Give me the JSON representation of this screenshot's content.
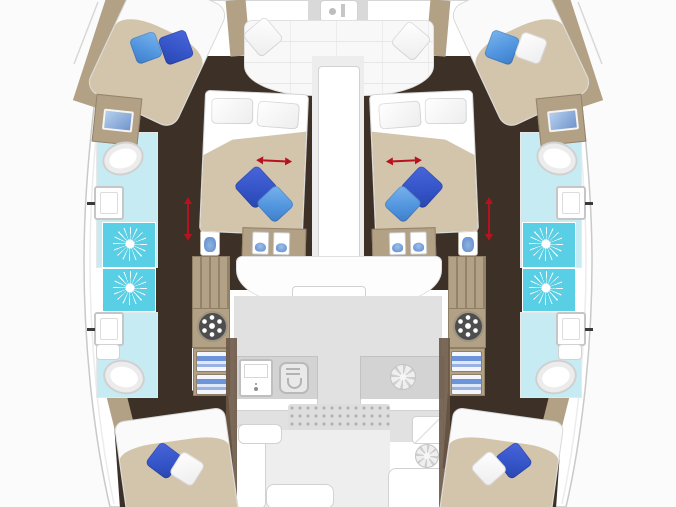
{
  "diagram": {
    "type": "catamaran-yacht-deck-floor-plan",
    "orientation": "bow-at-top, symmetric port/starboard hulls",
    "cabins": [
      {
        "name": "forward-cabin-port",
        "items": [
          "diagonal-double-bed",
          "navy-pillow",
          "blue-pillow",
          "vanity-with-sink",
          "toilet",
          "washbasin",
          "two-showers"
        ]
      },
      {
        "name": "forward-cabin-starboard",
        "items": [
          "diagonal-double-bed",
          "blue-pillow",
          "white-pillow",
          "vanity-with-sink",
          "toilet",
          "washbasin",
          "two-showers"
        ]
      },
      {
        "name": "guest-cabin-port-center",
        "items": [
          "island-double-bed",
          "two-white-pillows",
          "navy-pillow",
          "blue-pillow",
          "red-slide-arrow",
          "foot-shelf-with-two-basins"
        ]
      },
      {
        "name": "guest-cabin-starboard-center",
        "items": [
          "island-double-bed",
          "two-white-pillows",
          "navy-pillow",
          "blue-pillow",
          "red-slide-arrow",
          "foot-shelf-with-two-basins"
        ]
      },
      {
        "name": "aft-cabin-port",
        "items": [
          "double-bed",
          "navy-pillow",
          "white-pillow",
          "toilet",
          "washbasin"
        ]
      },
      {
        "name": "aft-cabin-starboard",
        "items": [
          "double-bed",
          "navy-pillow",
          "white-pillow",
          "toilet",
          "washbasin"
        ]
      }
    ],
    "common_areas": [
      "bow-lounge-with-cushions-and-two-white-pillows",
      "anchor-locker",
      "salon-front-bench",
      "galley-sink",
      "galley-stove",
      "galley-vent",
      "cockpit-grating",
      "l-sofa",
      "dining-table",
      "nav-station",
      "nav-fan",
      "companionway-steps-port",
      "companionway-steps-starboard",
      "washing-machine-port",
      "washing-machine-starboard",
      "corridor-red-arrows"
    ]
  },
  "palette": {
    "bg": "#fbfbfb",
    "hull_fill": "#ffffff",
    "hull_stroke": "#c9c9c9",
    "wood_dark": "#3c3027",
    "wood_tan": "#b2a185",
    "wood_tan_light": "#cfc1a6",
    "bed_spread": "#d3c5ab",
    "mattress": "#fafafa",
    "salon_floor": "#e1e1e1",
    "counter": "#d3d3d3",
    "cyan_light": "#c6ebf3",
    "cyan_bright": "#58cfe4",
    "pillow_navy": "#3353c6",
    "pillow_blue": "#4f93de",
    "pillow_white": "#f4f4f4",
    "red": "#b6121f",
    "appliance_gray": "#d9d9d9",
    "screen_blue": "#8cb4e2",
    "drawer_blue": "#6d93d8"
  }
}
